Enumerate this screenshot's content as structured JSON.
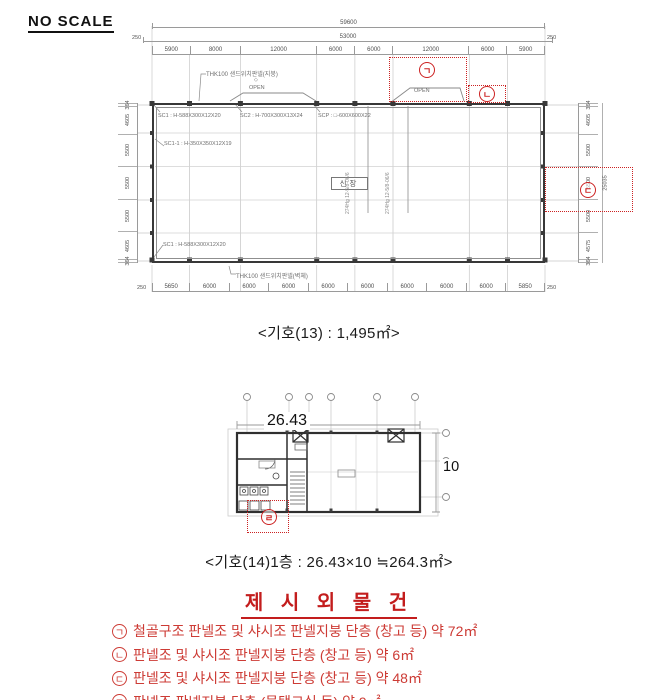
{
  "colors": {
    "red": "#cc2222",
    "line_dark": "#383838",
    "line_light": "#9a9a9a"
  },
  "header": {
    "no_scale": "NO SCALE"
  },
  "plan1": {
    "caption": "<기호(13) : 1,495㎡>",
    "top_dims": {
      "overall": "59600",
      "inner_overall": "53000",
      "end_left": "250",
      "end_right": "250",
      "segments": [
        "5900",
        "8000",
        "12000",
        "6000",
        "6000",
        "12000",
        "6000",
        "5900"
      ]
    },
    "bottom_dims": {
      "end_left": "250",
      "end_right": "250",
      "segments": [
        "5650",
        "6000",
        "6000",
        "6000",
        "6000",
        "6000",
        "6000",
        "6000",
        "6000",
        "5850"
      ]
    },
    "left_dims": [
      "364",
      "4605",
      "5500",
      "5500",
      "5500",
      "4605",
      "364"
    ],
    "right_dims": [
      "364",
      "4605",
      "5500",
      "5500",
      "5500",
      "4575",
      "364"
    ],
    "right_overall": "25035",
    "annotations": {
      "roof": "THK100 샌드위치판넬(지붕)",
      "wall_bottom": "THK100 샌드위치판넬(벽체)",
      "open_left": "OPEN",
      "open_right": "OPEN",
      "diamond": "◇",
      "sc1": "SC1 : H-588X300X12X20",
      "sc2": "SC2 : H-700X300X13X24",
      "scp": "SCP : □-600X600X22",
      "sc1_1": "SC1-1 : H-350X350X12X19",
      "sc1_bottom": "SC1 : H-588X300X12X20",
      "center_room": "신장",
      "column_note_1": "274Hg 12-5/8-06/6",
      "column_note_2": "274Hg 12-5/8-06/6"
    },
    "markers": {
      "g": "ㄱ",
      "n": "ㄴ",
      "d": "ㄷ"
    }
  },
  "plan2": {
    "caption": "<기호(14)1층 : 26.43×10 ≒264.3㎡>",
    "width_label": "26.43",
    "height_label": "10",
    "marker": "ㄹ"
  },
  "section": {
    "title": "제 시 외 물 건",
    "items": [
      {
        "jamo": "ㄱ",
        "text": "철골구조 판넬조 및 샤시조 판넬지붕 단층 (창고 등) 약 72㎡"
      },
      {
        "jamo": "ㄴ",
        "text": "판넬조 및 샤시조 판넬지붕 단층 (창고 등) 약 6㎡"
      },
      {
        "jamo": "ㄷ",
        "text": "판넬조 및 샤시조 판넬지붕 단층 (창고 등) 약 48㎡"
      },
      {
        "jamo": "ㄹ",
        "text": "판넬조 판넬지붕 단층 (물탱크실 등) 약 9㎡"
      }
    ]
  }
}
